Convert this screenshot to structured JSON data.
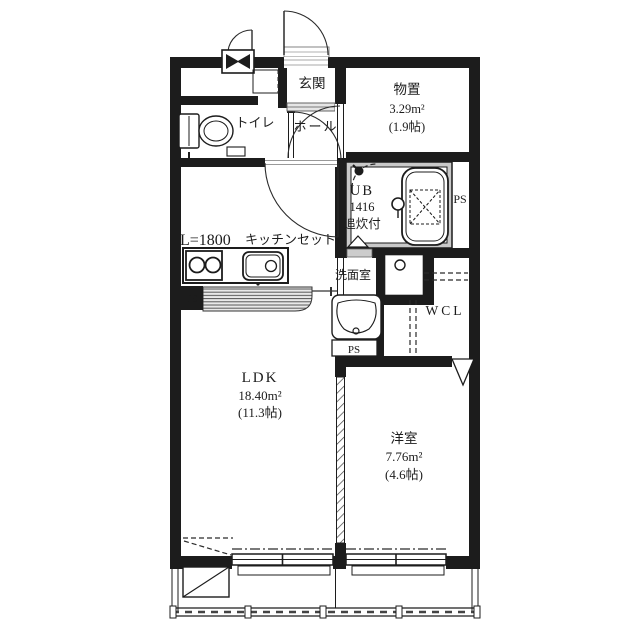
{
  "floor_plan": {
    "rooms": {
      "genkan": {
        "label": "玄関"
      },
      "hall": {
        "label": "ホール"
      },
      "toilet": {
        "label": "トイレ"
      },
      "storage": {
        "label": "物置",
        "area_m2": "3.29m²",
        "area_tatami": "(1.9帖)"
      },
      "unit_bath": {
        "label": "UB",
        "size": "1416",
        "feature": "追炊付"
      },
      "washroom": {
        "label": "洗面室"
      },
      "walk_in_closet": {
        "label": "WCL"
      },
      "ldk": {
        "label": "LDK",
        "area_m2": "18.40m²",
        "area_tatami": "(11.3帖)"
      },
      "western_room": {
        "label": "洋室",
        "area_m2": "7.76m²",
        "area_tatami": "(4.6帖)"
      }
    },
    "kitchen": {
      "length_label": "L=1800",
      "set_label": "キッチンセット"
    },
    "pipe_space": {
      "bath": "PS",
      "washroom": "PS",
      "kitchen": "PS"
    },
    "colors": {
      "ink": "#1c1c1c",
      "hatch": "#555555",
      "threshold": "#d9d9d9"
    }
  }
}
